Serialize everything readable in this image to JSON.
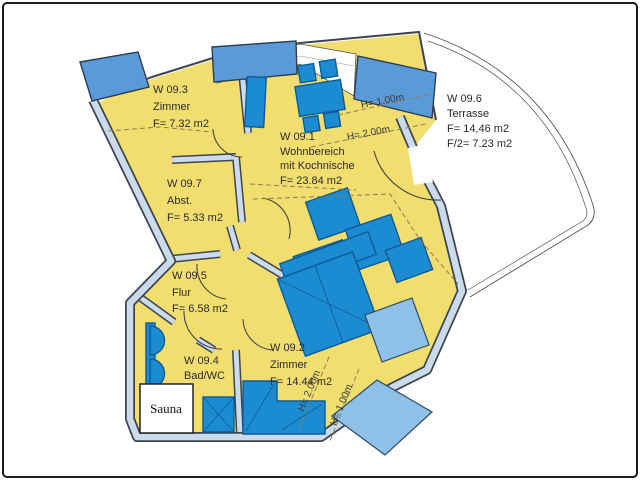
{
  "plan": {
    "rooms": {
      "w093": {
        "id": "W 09.3",
        "name": "Zimmer",
        "area": "F= 7.32 m2"
      },
      "w091": {
        "id": "W 09.1",
        "name_line1": "Wohnbereich",
        "name_line2": "mit Kochnische",
        "area": "F= 23.84 m2"
      },
      "w097": {
        "id": "W 09.7",
        "name": "Abst.",
        "area": "F= 5.33 m2"
      },
      "w095": {
        "id": "W 09.5",
        "name": "Flur",
        "area": "F= 6.58 m2"
      },
      "w094": {
        "id": "W 09.4",
        "name": "Bad/WC"
      },
      "w092": {
        "id": "W 09.2",
        "name": "Zimmer",
        "area": "F= 14.44 m2"
      },
      "w096": {
        "id": "W 09.6",
        "name": "Terrasse",
        "area": "F= 14,46 m2",
        "area_half": "F/2= 7.23 m2"
      },
      "sauna": {
        "name": "Sauna"
      }
    },
    "height_marks": {
      "top_h100": "H=  1.00m",
      "top_h200": "H=  2.00m",
      "bottom_h200": "H= 2.00m",
      "bottom_h100": "H= 1.00m"
    },
    "colors": {
      "room_fill": "#f2de6e",
      "furniture_blue": "#1c8cd2",
      "balcony_blue": "#5b9ad9",
      "balcony_light_blue": "#8fc0e8",
      "wall_band": "#cadbec",
      "wall_outline": "#3e4450"
    }
  }
}
